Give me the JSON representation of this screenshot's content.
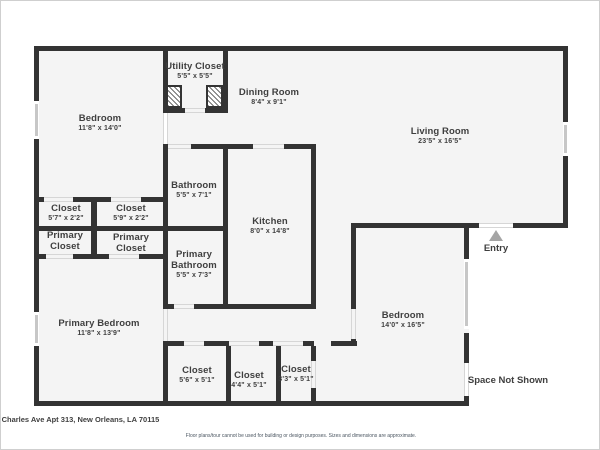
{
  "plan": {
    "rooms": {
      "bedroom_top": {
        "name": "Bedroom",
        "dims": "11'8\" x 14'0\""
      },
      "utility_closet": {
        "name": "Utility Closet",
        "dims": "5'5\" x 5'5\""
      },
      "dining_room": {
        "name": "Dining Room",
        "dims": "8'4\" x 9'1\""
      },
      "living_room": {
        "name": "Living Room",
        "dims": "23'5\" x 16'5\""
      },
      "bathroom": {
        "name": "Bathroom",
        "dims": "5'5\" x 7'1\""
      },
      "closet_left_a": {
        "name": "Closet",
        "dims": "5'7\" x 2'2\""
      },
      "closet_left_b": {
        "name": "Closet",
        "dims": "5'9\" x 2'2\""
      },
      "primary_closet_a": {
        "name": "Primary Closet"
      },
      "primary_closet_b": {
        "name": "Primary Closet"
      },
      "kitchen": {
        "name": "Kitchen",
        "dims": "8'0\" x 14'8\""
      },
      "primary_bathroom": {
        "name": "Primary Bathroom",
        "dims": "5'5\" x 7'3\""
      },
      "primary_bedroom": {
        "name": "Primary Bedroom",
        "dims": "11'8\" x 13'9\""
      },
      "bedroom_right": {
        "name": "Bedroom",
        "dims": "14'0\" x 16'5\""
      },
      "closet_bottom_a": {
        "name": "Closet",
        "dims": "5'6\" x 5'1\""
      },
      "closet_bottom_b": {
        "name": "Closet",
        "dims": "4'4\" x 5'1\""
      },
      "closet_bottom_c": {
        "name": "Closet",
        "dims": "3'3\" x 5'1\""
      }
    },
    "annotations": {
      "entry": "Entry",
      "space_not_shown": "Space Not Shown"
    }
  },
  "footer": {
    "address": "St Charles Ave Apt 313, New Orleans, LA 70115",
    "disclaimer": "Floor plans/tour cannot be used for building or design purposes. Sizes and dimensions are approximate."
  },
  "colors": {
    "wall": "#333333",
    "floor": "#f4f4f4",
    "window_glass": "#c7c7c7",
    "label_text": "#3f3f3f",
    "entry_arrow": "#a5a5a5"
  }
}
